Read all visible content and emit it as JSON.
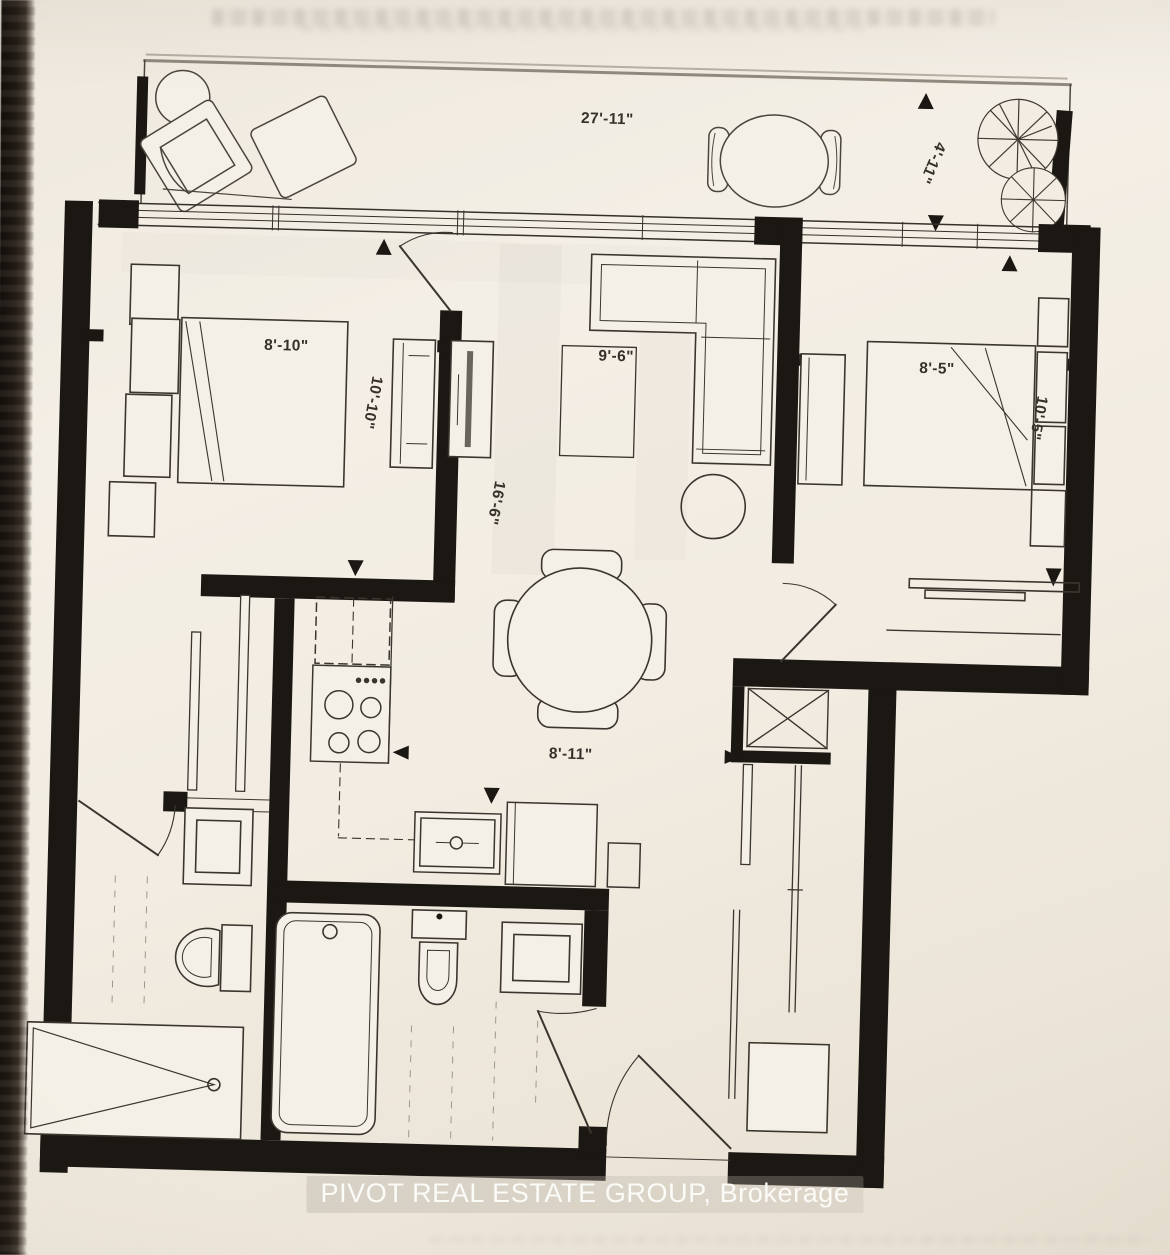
{
  "labels": {
    "balcony_width": "27'-11\"",
    "balcony_depth": "4'-11\"",
    "bedroom1_width": "8'-10\"",
    "bedroom1_length": "10'-10\"",
    "living_width": "9'-6\"",
    "living_length": "16'-6\"",
    "bedroom2_width": "8'-5\"",
    "bedroom2_length": "10'-5\"",
    "kitchen_dining_width": "8'-11\"",
    "watermark": "PIVOT REAL ESTATE GROUP, Brokerage"
  },
  "colors": {
    "paper": "#f2ece2",
    "wall": "#1b1713",
    "line": "#3a362f",
    "watermark_text": "#fdfdfb",
    "photo_edge": "#14100c"
  }
}
